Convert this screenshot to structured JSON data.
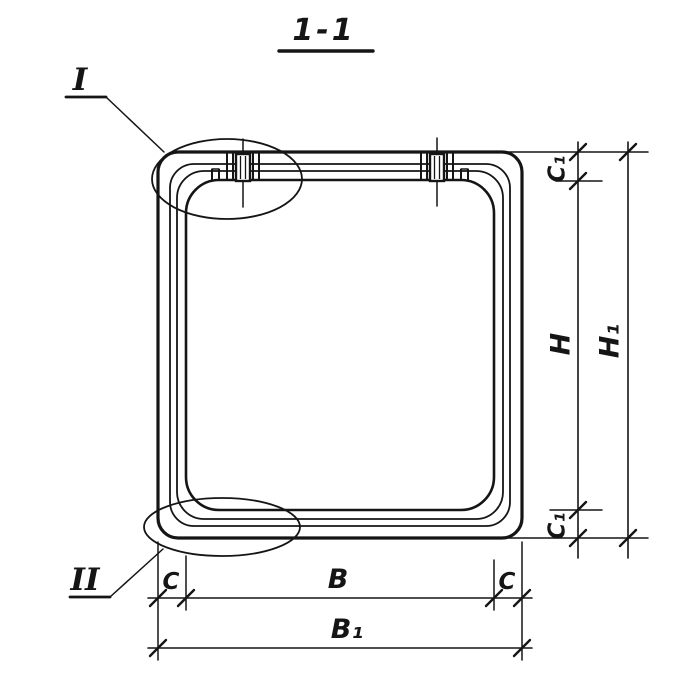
{
  "title": "1-1",
  "callouts": {
    "top": "I",
    "bottom": "II"
  },
  "dims": {
    "c_left": "C",
    "b": "B",
    "c_right": "C",
    "b1": "B₁",
    "c1_top": "C₁",
    "h": "H",
    "h1": "H₁",
    "c1_bottom": "C₁"
  },
  "colors": {
    "ink": "#151515",
    "paper": "#ffffff"
  }
}
